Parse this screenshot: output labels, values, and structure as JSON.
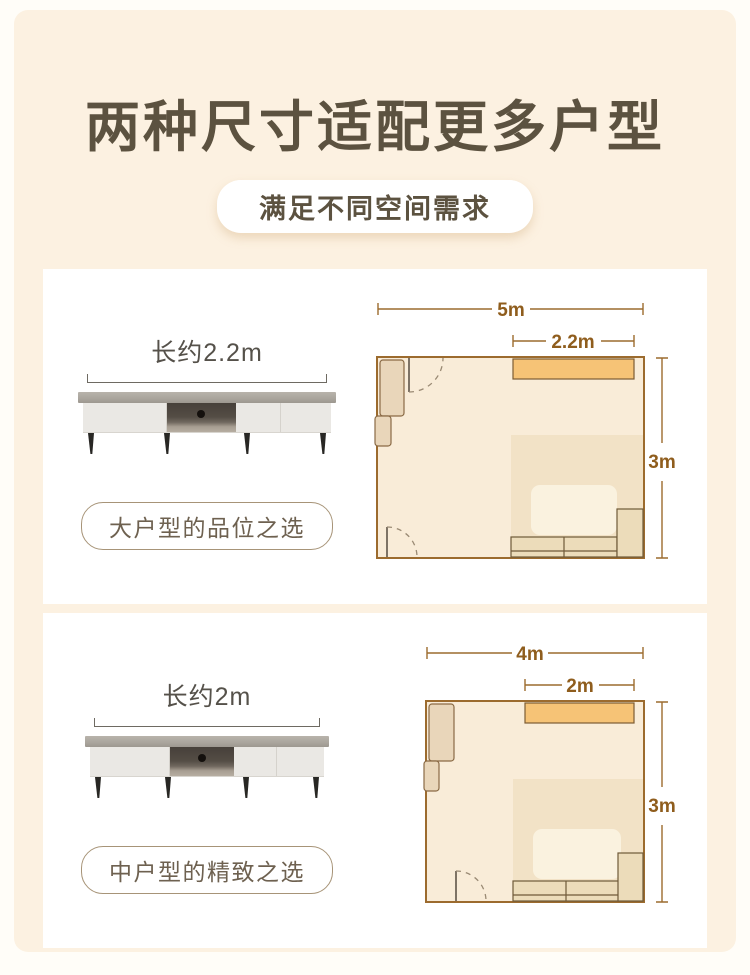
{
  "header": {
    "title": "两种尺寸适配更多户型",
    "subtitle": "满足不同空间需求"
  },
  "colors": {
    "accent_orange": "#f6c376",
    "plan_line": "#9c6b2e",
    "plan_text": "#8f5d1d",
    "title_text": "#5c5240",
    "cream_bg": "#fcf1e1",
    "room_fill": "#f9ecd8"
  },
  "cards": [
    {
      "length_label": "长约2.2m",
      "tagline": "大户型的品位之选",
      "floorplan": {
        "room_width": "5m",
        "tv_width": "2.2m",
        "room_depth": "3m"
      }
    },
    {
      "length_label": "长约2m",
      "tagline": "中户型的精致之选",
      "floorplan": {
        "room_width": "4m",
        "tv_width": "2m",
        "room_depth": "3m"
      }
    }
  ]
}
